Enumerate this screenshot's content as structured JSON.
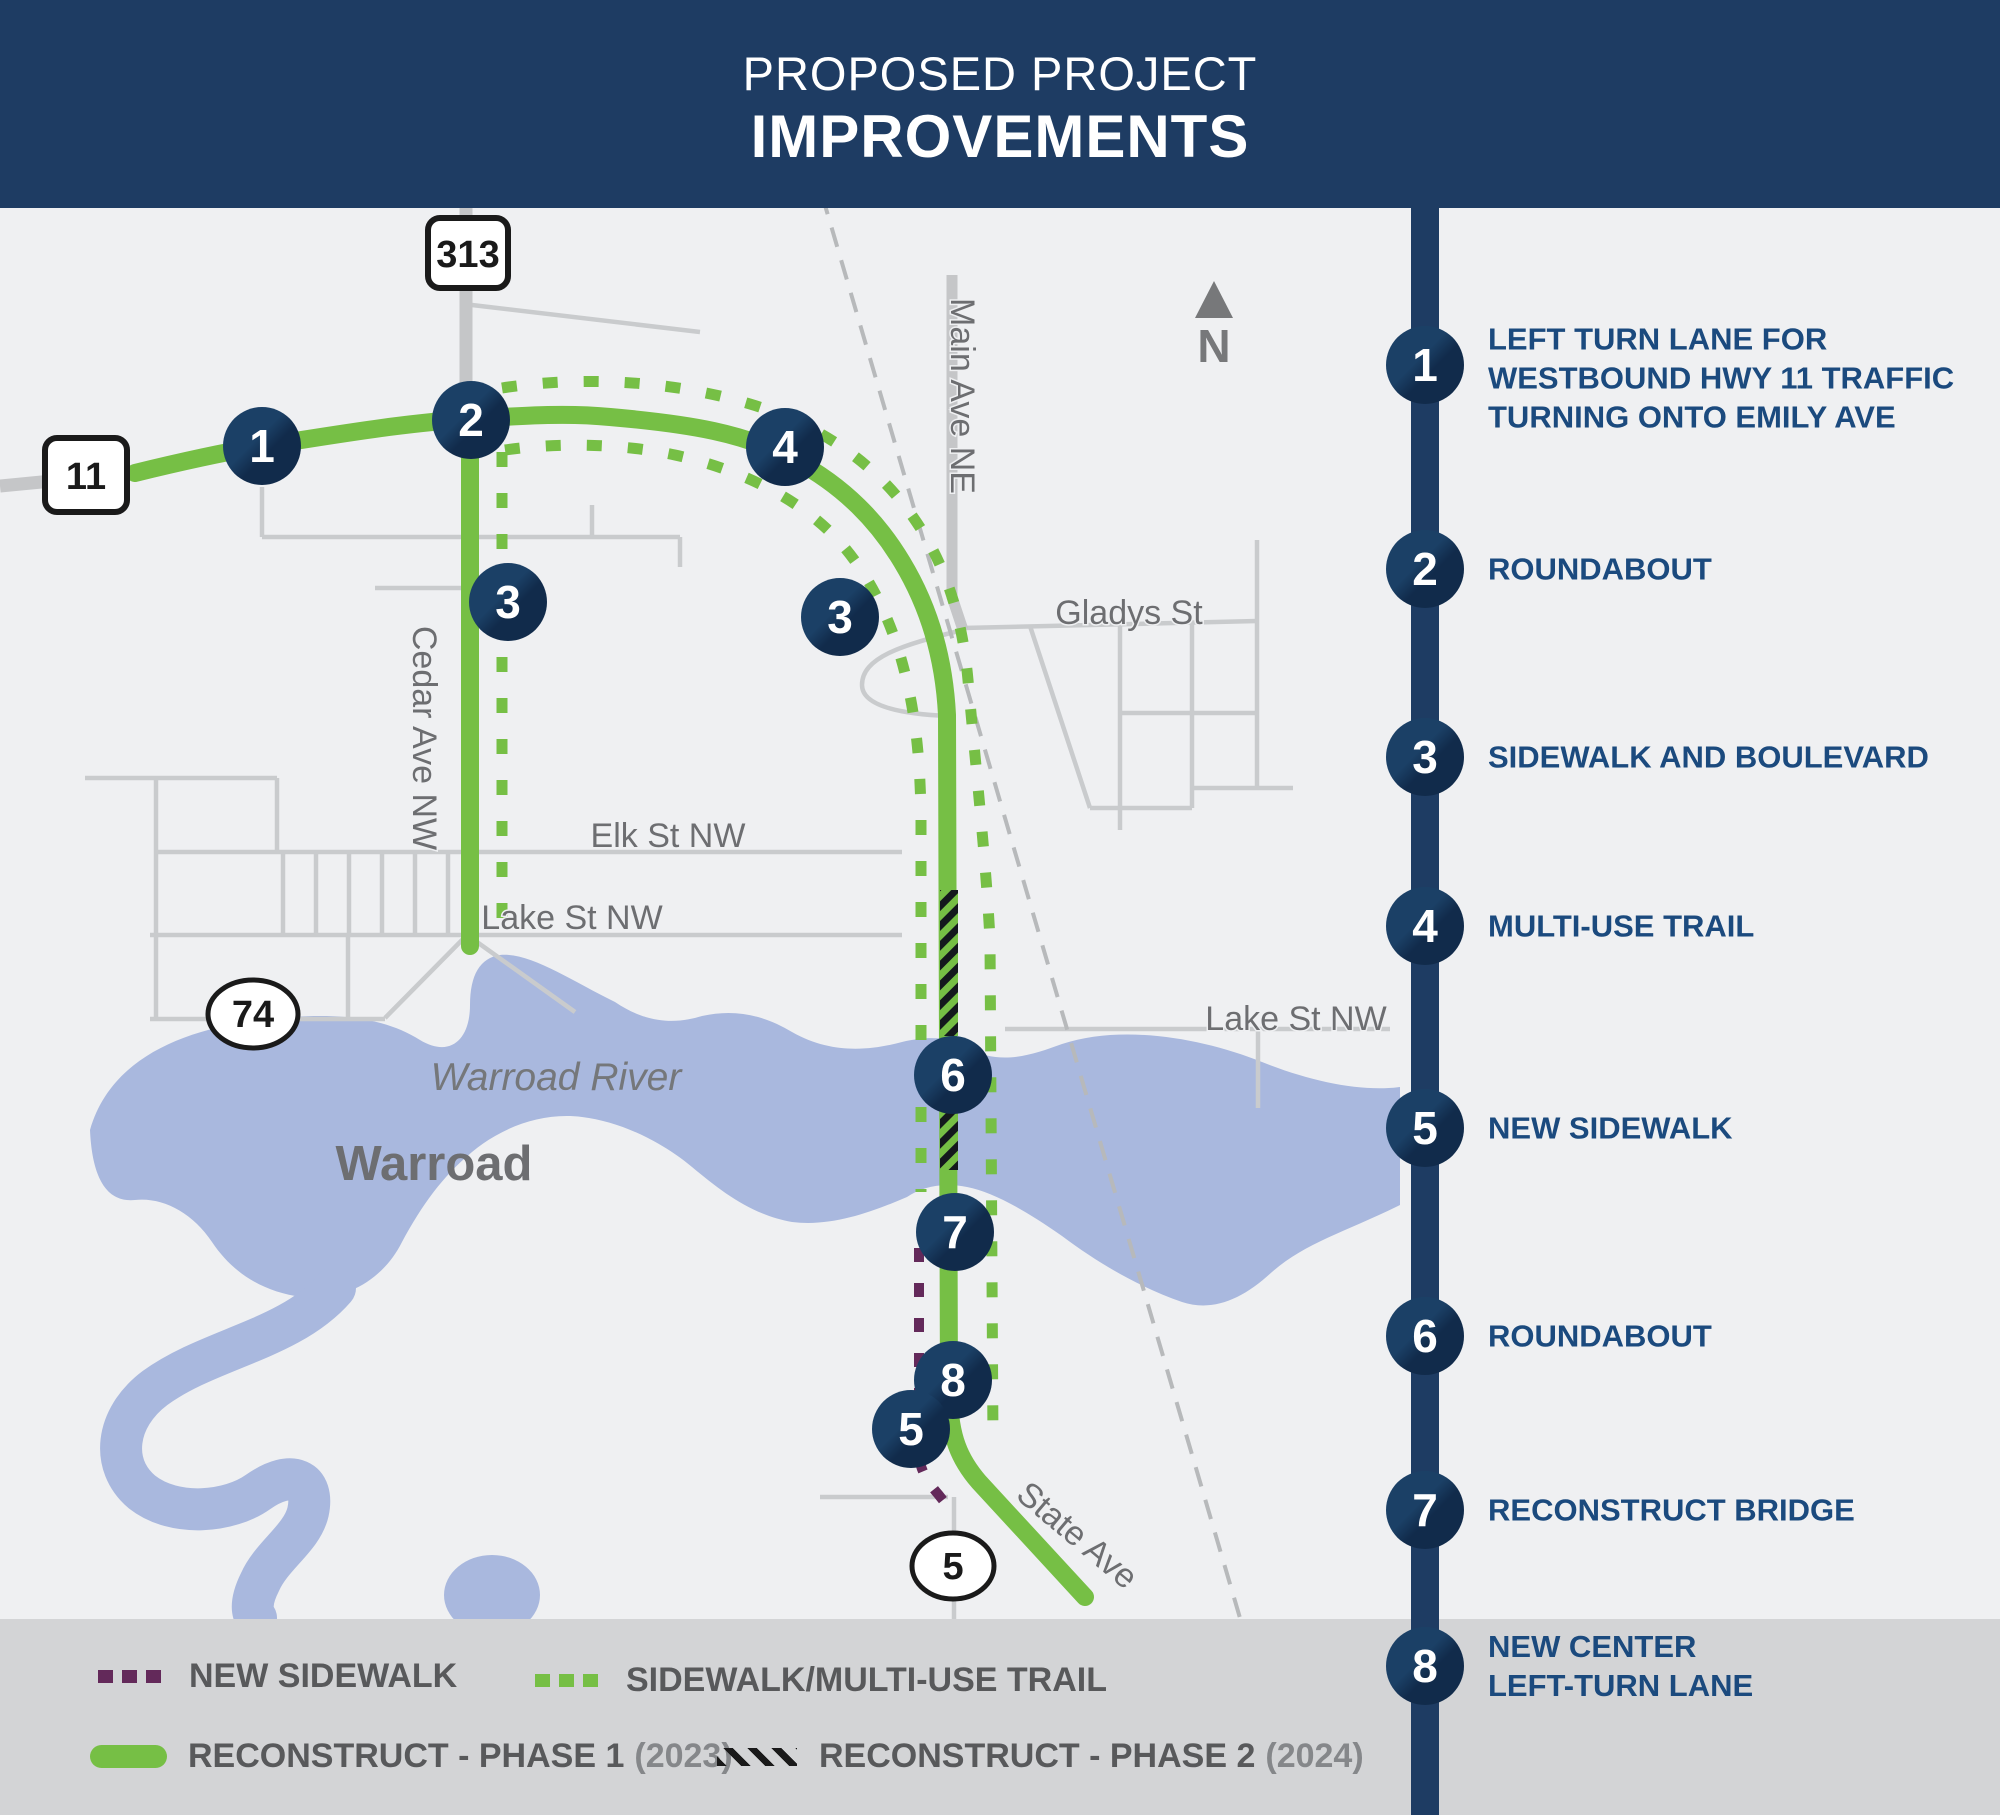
{
  "header": {
    "title_line1": "PROPOSED PROJECT",
    "title_line2": "IMPROVEMENTS"
  },
  "sidebar": {
    "items": [
      {
        "number": "1",
        "lines": [
          "LEFT TURN LANE FOR",
          "WESTBOUND HWY 11 TRAFFIC",
          "TURNING ONTO EMILY AVE"
        ]
      },
      {
        "number": "2",
        "lines": [
          "ROUNDABOUT"
        ]
      },
      {
        "number": "3",
        "lines": [
          "SIDEWALK AND BOULEVARD"
        ]
      },
      {
        "number": "4",
        "lines": [
          "MULTI-USE TRAIL"
        ]
      },
      {
        "number": "5",
        "lines": [
          "NEW SIDEWALK"
        ]
      },
      {
        "number": "6",
        "lines": [
          "ROUNDABOUT"
        ]
      },
      {
        "number": "7",
        "lines": [
          "RECONSTRUCT BRIDGE"
        ]
      },
      {
        "number": "8",
        "lines": [
          "NEW CENTER",
          "LEFT-TURN LANE"
        ]
      }
    ]
  },
  "legend": {
    "new_sidewalk": "NEW SIDEWALK",
    "trail": "SIDEWALK/MULTI-USE TRAIL",
    "phase1": "RECONSTRUCT - PHASE 1",
    "phase1_year": "(2023)",
    "phase2": "RECONSTRUCT - PHASE 2",
    "phase2_year": "(2024)"
  },
  "map": {
    "shields": {
      "s313": "313",
      "s11": "11",
      "s74": "74",
      "s5": "5"
    },
    "labels": {
      "cedar": "Cedar Ave NW",
      "main": "Main Ave NE",
      "gladys": "Gladys St",
      "elk": "Elk St NW",
      "lake_w": "Lake St NW",
      "lake_e": "Lake St NW",
      "river": "Warroad River",
      "city": "Warroad",
      "state": "State Ave",
      "north": "N"
    },
    "markers": [
      {
        "n": "1"
      },
      {
        "n": "2"
      },
      {
        "n": "3"
      },
      {
        "n": "4"
      },
      {
        "n": "3"
      },
      {
        "n": "6"
      },
      {
        "n": "7"
      },
      {
        "n": "8"
      },
      {
        "n": "5"
      }
    ]
  },
  "colors": {
    "navy": "#1e3c63",
    "green": "#76bf45",
    "purple": "#63295a",
    "river": "#a9b8de",
    "legend_band": "#d3d4d6"
  }
}
